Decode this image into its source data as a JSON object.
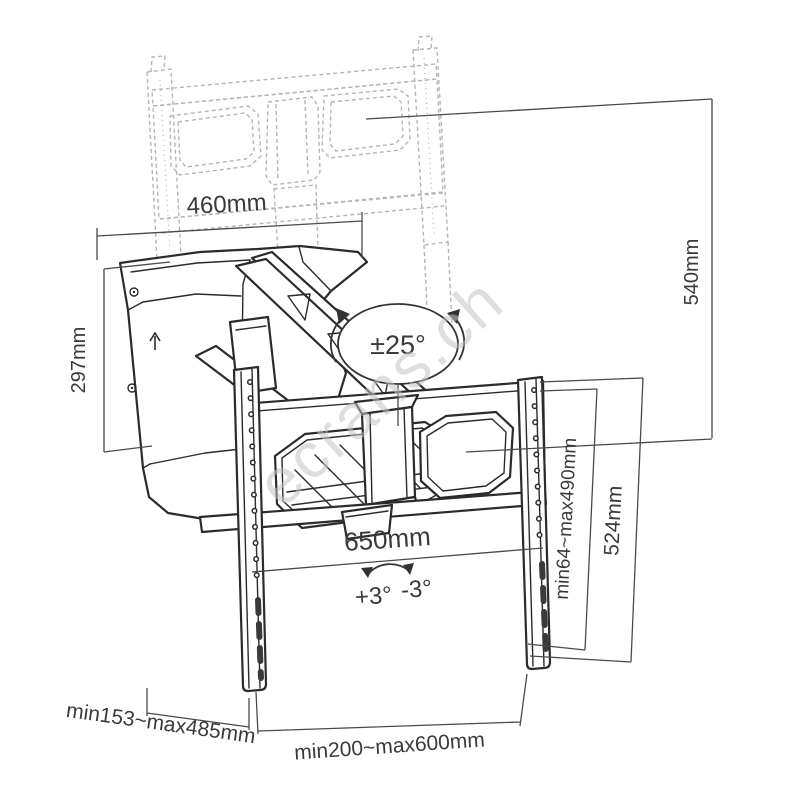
{
  "watermark": {
    "text": "ecrans.ch"
  },
  "diagram": {
    "type": "technical-drawing",
    "subject": "motorized pull-down TV wall mount dimension drawing",
    "dims": {
      "plate_width": "460mm",
      "drop_height": "540mm",
      "plate_height": "297mm",
      "swivel_range": "±25°",
      "bracket_width": "650mm",
      "tilt_plus": "+3°",
      "tilt_minus": "-3°",
      "vesa_vertical_range": "min64~max490mm",
      "rail_height": "524mm",
      "wall_distance_range": "min153~max485mm",
      "vesa_horizontal_range": "min200~max600mm"
    },
    "colors": {
      "background": "#ffffff",
      "line": "#2b2b2b",
      "dim_line": "#4a4a4a",
      "ghost_line": "#b5b5b5",
      "watermark": "#c4c4c4"
    }
  }
}
